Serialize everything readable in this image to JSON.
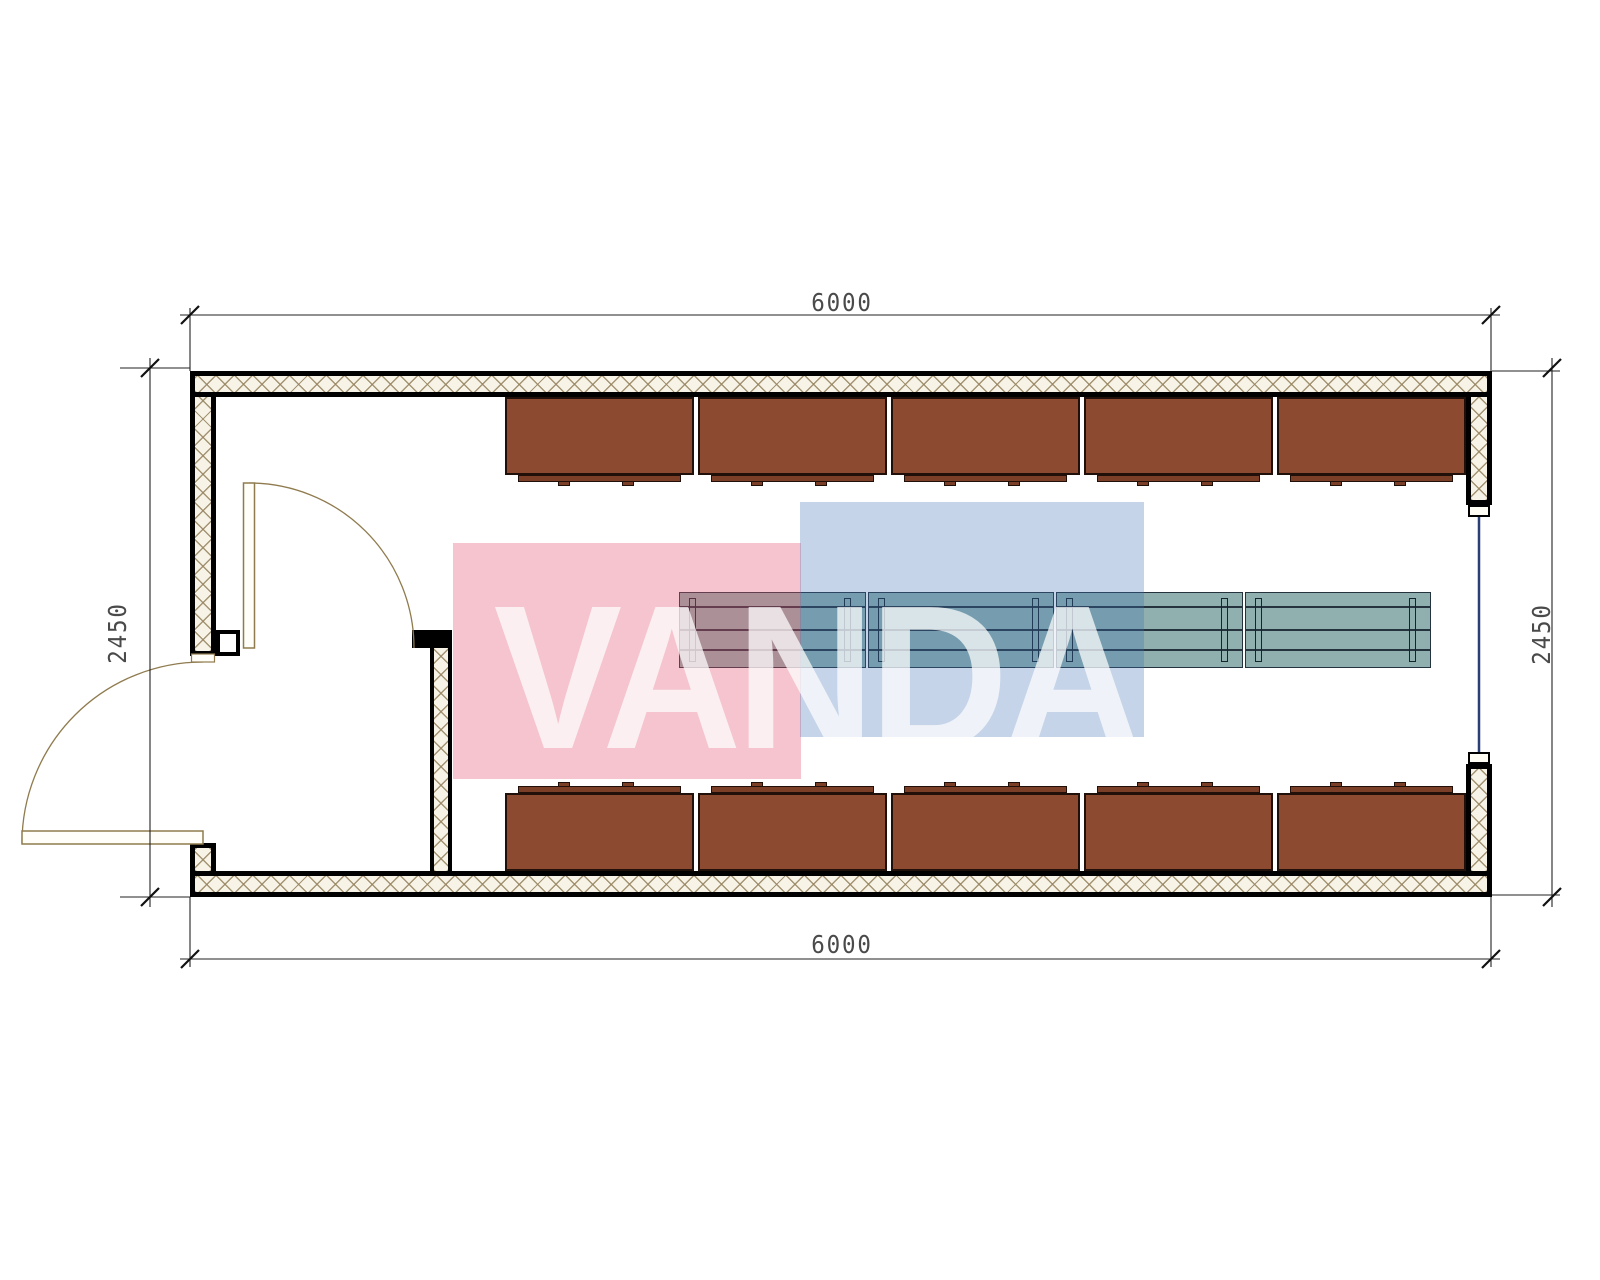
{
  "dimensions": {
    "top": "6000",
    "bottom": "6000",
    "left": "2450",
    "right": "2450"
  },
  "watermark": {
    "text": "VANDA",
    "red_square_color": "rgba(227,82,112,0.34)",
    "blue_square_color": "rgba(62,112,178,0.30)"
  },
  "furniture": {
    "locker_rows": [
      {
        "position": "top",
        "count": 5
      },
      {
        "position": "bottom",
        "count": 5
      }
    ],
    "locker_color": "#8c4a30",
    "locker_base_color": "#7a3f26",
    "table_sections": 4,
    "table_color": "#8fb0ae"
  },
  "colors": {
    "wall_face": "#000000",
    "wall_hatch_bg": "#f7f3e6",
    "wall_hatch_line": "rgba(150,132,96,0.85)",
    "door": "#8f7b4e",
    "glazing": "#2b3f77",
    "dimension_line": "#222222",
    "dimension_text": "#4a4a4a"
  }
}
